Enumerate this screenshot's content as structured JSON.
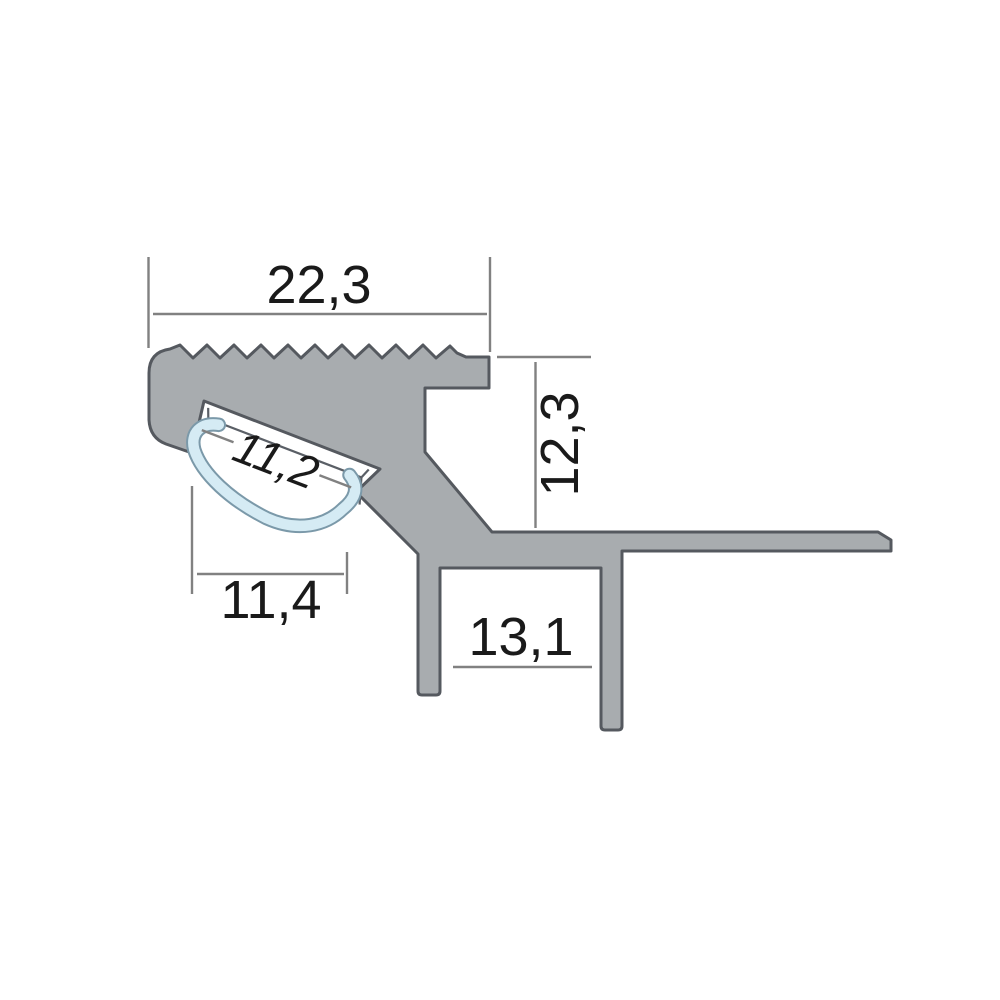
{
  "figure": {
    "type": "technical-cross-section",
    "subject": "aluminium LED stair-nosing profile",
    "background": "#ffffff",
    "dimensions": {
      "top_width": "22,3",
      "height_right": "12,3",
      "channel_width": "11,2",
      "nose_bottom_width": "11,4",
      "pocket_width": "13,1"
    },
    "colors": {
      "profile_fill": "#a8acaf",
      "profile_outline": "#55595f",
      "diffuser_fill": "#d5ebf4",
      "diffuser_outline": "#7b99a9",
      "dimension_line": "#818181",
      "dimension_text": "#1a1a1a"
    }
  }
}
